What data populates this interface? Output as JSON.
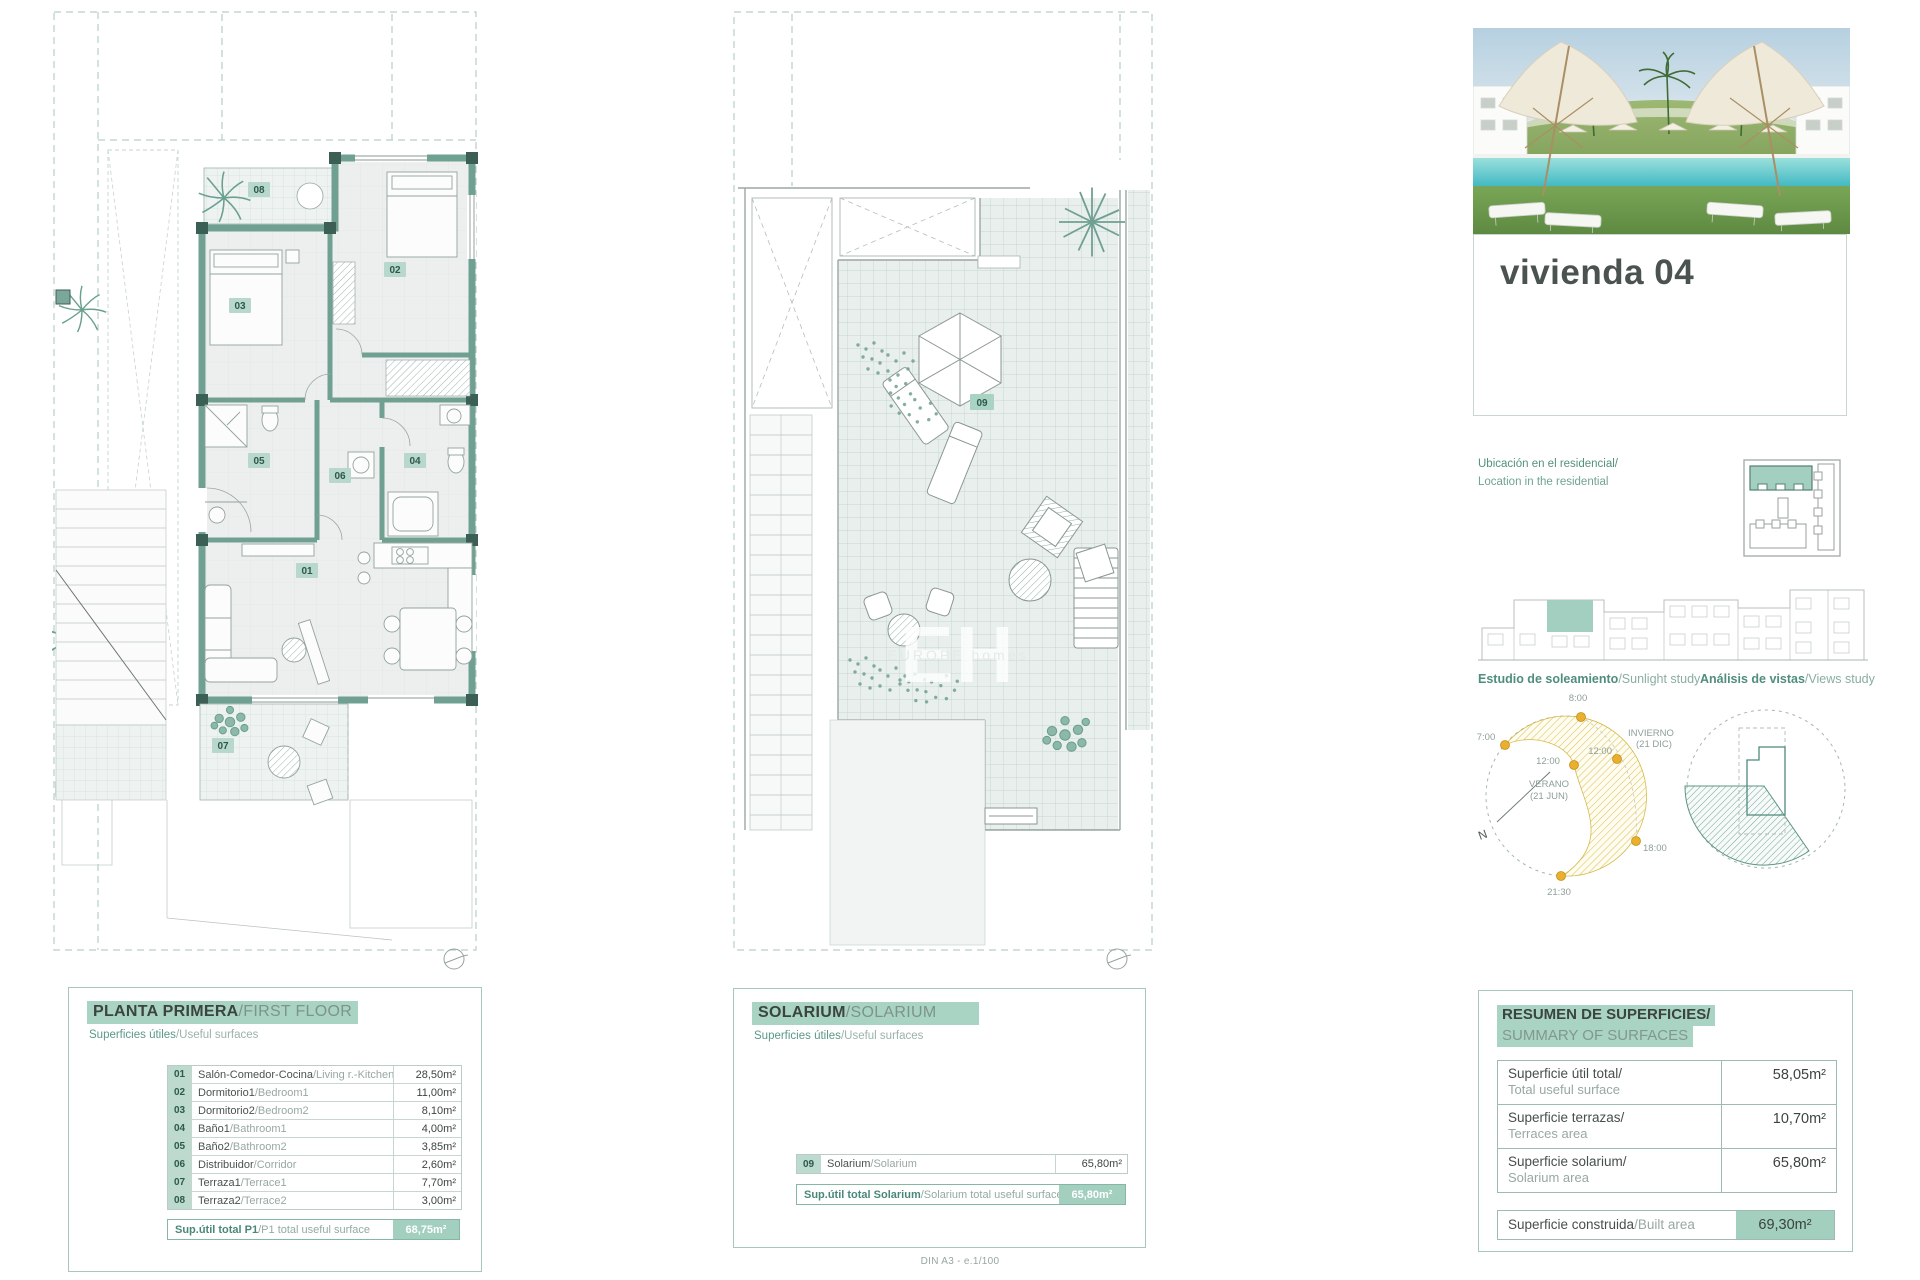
{
  "sheet": {
    "scale_note": "DIN A3 - e.1/100"
  },
  "unit": {
    "title": "vivienda 04"
  },
  "first_floor": {
    "title_es": "PLANTA PRIMERA",
    "title_en": "/FIRST FLOOR",
    "subtitle_es": "Superficies útiles",
    "subtitle_en": "/Useful surfaces",
    "rows": [
      {
        "code": "01",
        "name_es": "Salón-Comedor-Cocina",
        "name_en": "/Living r.-Kitchen",
        "value": "28,50m²"
      },
      {
        "code": "02",
        "name_es": "Dormitorio1",
        "name_en": "/Bedroom1",
        "value": "11,00m²"
      },
      {
        "code": "03",
        "name_es": "Dormitorio2",
        "name_en": "/Bedroom2",
        "value": "8,10m²"
      },
      {
        "code": "04",
        "name_es": "Baño1",
        "name_en": "/Bathroom1",
        "value": "4,00m²"
      },
      {
        "code": "05",
        "name_es": "Baño2",
        "name_en": "/Bathroom2",
        "value": "3,85m²"
      },
      {
        "code": "06",
        "name_es": "Distribuidor",
        "name_en": "/Corridor",
        "value": "2,60m²"
      },
      {
        "code": "07",
        "name_es": "Terraza1",
        "name_en": "/Terrace1",
        "value": "7,70m²"
      },
      {
        "code": "08",
        "name_es": "Terraza2",
        "name_en": "/Terrace2",
        "value": "3,00m²"
      }
    ],
    "total_es": "Sup.útil total P1",
    "total_en": "/P1 total useful surface",
    "total_value": "68,75m²"
  },
  "solarium": {
    "title_es": "SOLARIUM",
    "title_en": "/SOLARIUM",
    "subtitle_es": "Superficies útiles",
    "subtitle_en": "/Useful surfaces",
    "row": {
      "code": "09",
      "name_es": "Solarium",
      "name_en": "/Solarium",
      "value": "65,80m²"
    },
    "total_es": "Sup.útil total Solarium",
    "total_en": "/Solarium total useful surface",
    "total_value": "65,80m²"
  },
  "summary": {
    "title_line1": "RESUMEN DE SUPERFICIES/",
    "title_line2": "SUMMARY OF SURFACES",
    "rows": [
      {
        "label_es": "Superficie útil total/",
        "label_en": "Total useful surface",
        "value": "58,05m²"
      },
      {
        "label_es": "Superficie terrazas/",
        "label_en": "Terraces area",
        "value": "10,70m²"
      },
      {
        "label_es": "Superficie solarium/",
        "label_en": "Solarium area",
        "value": "65,80m²"
      }
    ],
    "built_es": "Superficie construida",
    "built_en": "/Built area",
    "built_value": "69,30m²"
  },
  "location": {
    "line1": "Ubicación en el residencial/",
    "line2": "Location in the residential"
  },
  "sunlight": {
    "title_es": "Estudio de soleamiento",
    "title_en": "/Sunlight study",
    "t7": "7:00",
    "t8": "8:00",
    "t12_outer": "12:00",
    "t12_inner": "12:00",
    "winter_1": "INVIERNO",
    "winter_2": "(21 DIC)",
    "summer_1": "VERANO",
    "summer_2": "(21 JUN)",
    "t18": "18:00",
    "t2130": "21:30",
    "north": "N"
  },
  "views": {
    "title_es": "Análisis de vistas",
    "title_en": "/Views study"
  },
  "plan_rooms": {
    "r01": "01",
    "r02": "02",
    "r03": "03",
    "r04": "04",
    "r05": "05",
    "r06": "06",
    "r07": "07",
    "r08": "08",
    "r09": "09"
  },
  "watermark": {
    "monogram": "EH",
    "name": "EUROPE homes"
  }
}
